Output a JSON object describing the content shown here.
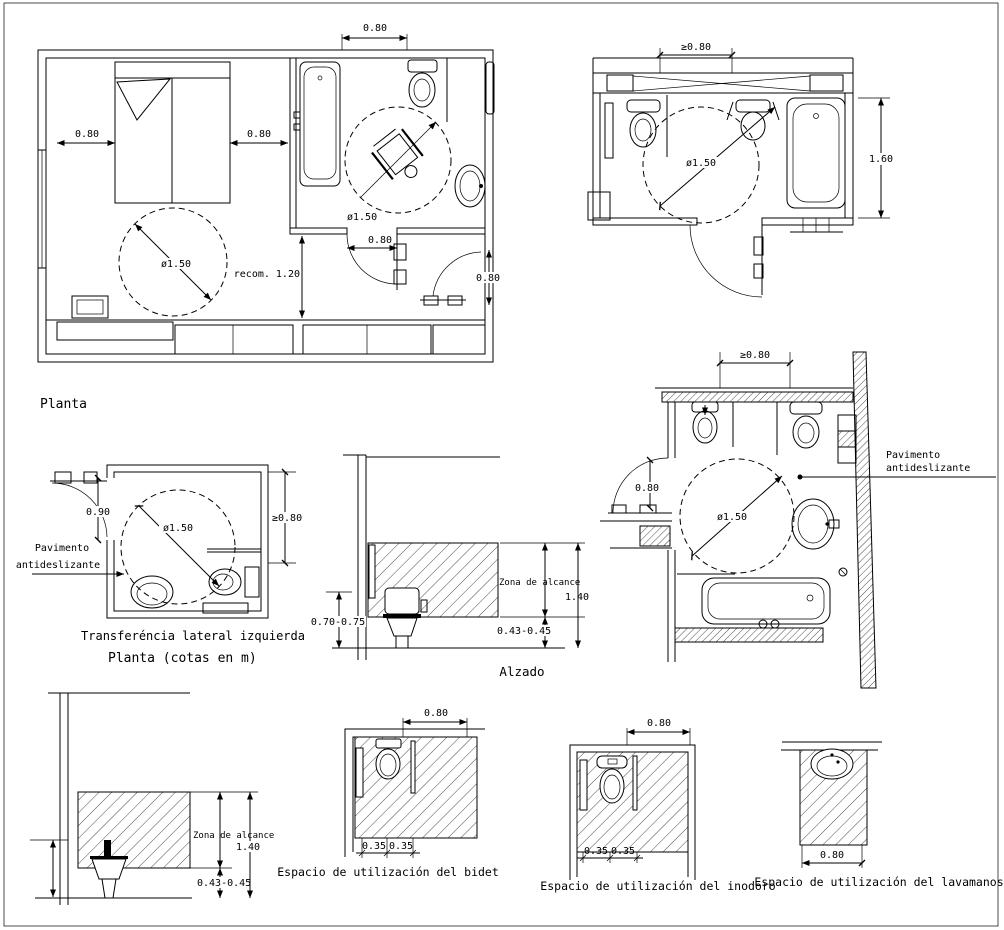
{
  "page": {
    "paper": "#ffffff",
    "ink": "#000000"
  },
  "plan_bedroom": {
    "caption": "Planta",
    "dim_top": "0.80",
    "dim_left": "0.80",
    "dim_mid": "0.80",
    "turning_circle": "ø1.50",
    "bath_circle": "ø1.50",
    "bath_door": "0.80",
    "recom": "recom. 1.20",
    "entry_door": "0.80"
  },
  "plan_topright": {
    "dim_top": "≥0.80",
    "turning_circle": "ø1.50",
    "dim_right": "1.60"
  },
  "plan_transfer": {
    "dim_door": "0.90",
    "turning_circle": "ø1.50",
    "dim_right": "≥0.80",
    "floor_label_1": "Pavimento",
    "floor_label_2": "antideslizante",
    "caption_1": "Transferéncia lateral izquierda",
    "caption_2": "Planta  (cotas en m)"
  },
  "elevation_alzado": {
    "dim_left": "0.70-0.75",
    "zone_label": "Zona de alcance",
    "dim_height": "1.40",
    "dim_seat": "0.43-0.45",
    "caption": "Alzado"
  },
  "plan_midright": {
    "dim_top": "≥0.80",
    "dim_door": "0.80",
    "turning_circle": "ø1.50",
    "floor_label_1": "Pavimento",
    "floor_label_2": "antideslizante"
  },
  "elevation_bidet": {
    "zone_label": "Zona de alcance",
    "dim_height": "1.40",
    "dim_seat": "0.43-0.45"
  },
  "space_bidet": {
    "dim_top": "0.80",
    "dim_a": "0.35",
    "dim_b": "0.35",
    "caption": "Espacio de utilización del bidet"
  },
  "space_inodoro": {
    "dim_top": "0.80",
    "dim_a": "0.35",
    "dim_b": "0.35",
    "caption": "Espacio de utilización del inodoro"
  },
  "space_lavamanos": {
    "dim_bottom": "0.80",
    "caption": "Espacio de utilización del lavamanos"
  }
}
